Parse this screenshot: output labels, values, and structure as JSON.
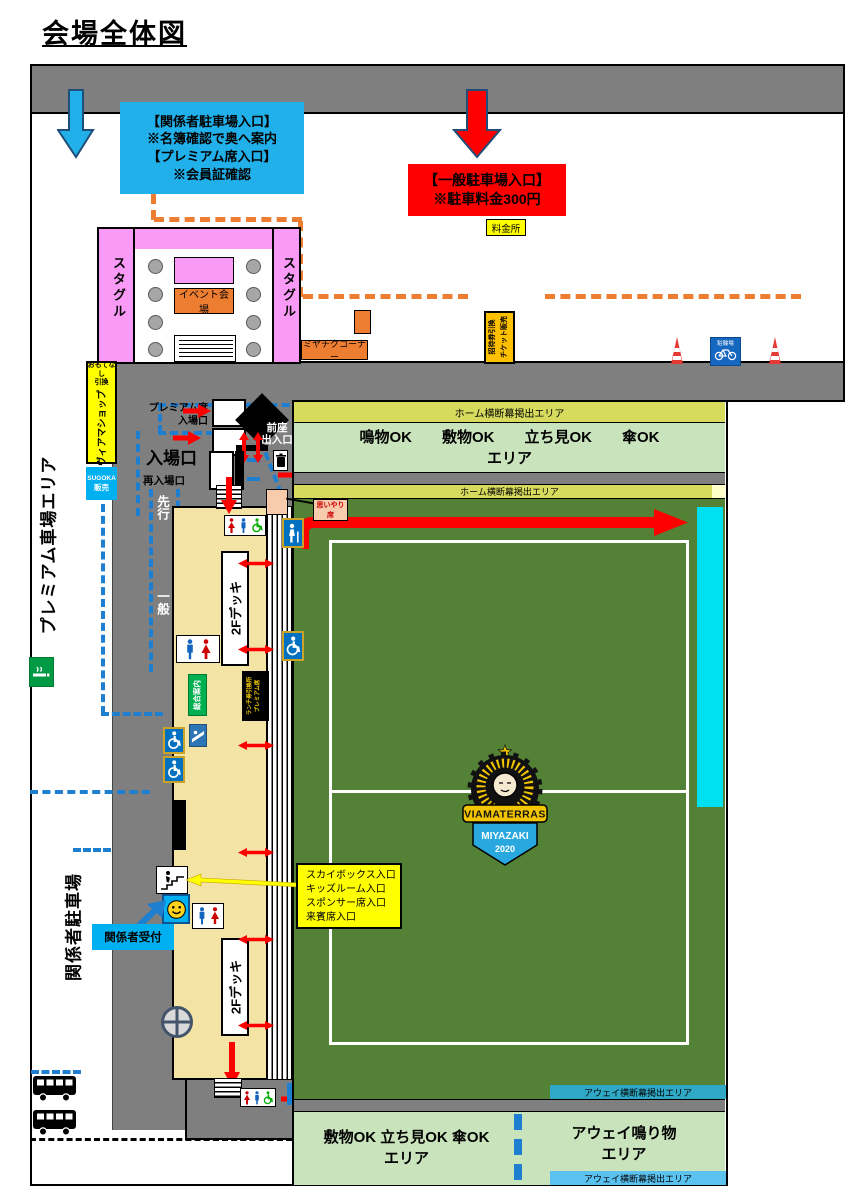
{
  "title": "会場全体図",
  "colors": {
    "accent_blue": "#22B0EA",
    "route_blue": "#1E7FD0",
    "arrow_red": "#FF0000",
    "orange": "#ED7D31",
    "banner_yellow": "#D6DB5E",
    "field_green": "#538135",
    "free_area_green": "#C9E3BC",
    "stand_tan": "#F3E3A5",
    "pink": "#F99BF6",
    "cyan_seats": "#00E0F0",
    "away_teal": "#2FA8C5",
    "away_lightblue": "#5BC2EF"
  },
  "notes": {
    "staff_parking_entrance": "【関係者駐車場入口】\n※名簿確認で奥へ案内\n【プレミアム席入口】\n※会員証確認",
    "general_parking_entrance": "【一般駐車場入口】\n※駐車料金300円",
    "toll_booth": "料金所",
    "skybox_entrances": "スカイボックス入口\nキッズルーム入口\nスポンサー席入口\n来賓席入口",
    "staff_reception": "関係者受付"
  },
  "areas": {
    "premium_parking": "プレミアム車場エリア",
    "staff_parking": "関係者駐車場",
    "stagle_left": "スタグル",
    "stagle_right": "スタグル",
    "event_hall": "イベント会場",
    "miyachiku": "ミヤチクコーナー",
    "home_banner_top": "ホーム横断幕掲出エリア",
    "home_banner_bottom": "ホーム横断幕掲出エリア",
    "home_free_area": "鳴物OK　　敷物OK　　立ち見OK　　傘OK\nエリア",
    "away_banner_top": "アウェイ横断幕掲出エリア",
    "away_banner_bottom": "アウェイ横断幕掲出エリア",
    "away_free_area": "敷物OK  立ち見OK  傘OK\nエリア",
    "away_noise_area": "アウェイ鳴り物\nエリア",
    "courtesy_seat": "思いやり席"
  },
  "facilities": {
    "hospitality_exchange": "おもてなし\n引換",
    "viama_shop": "ヴィアマショップ",
    "sugoka_line1": "SUGOKA",
    "sugoka_line2": "販売",
    "invitation_exchange": "招待券引換",
    "ticket_sales": "チケット販売",
    "bicycle_parking": "駐輪場",
    "info_center": "総合案内",
    "lunch_exchange": "ランチ券引換所",
    "premium_seat": "プレミアム席",
    "deck_2f": "2Fデッキ"
  },
  "gates": {
    "premium_gate": "プレミアム席\n入場口",
    "entrance": "入場口",
    "reentrance": "再入場口",
    "zenza_gate": "前座\n出入口",
    "lane_priority": "先行",
    "lane_general": "一般"
  },
  "logo": {
    "banner": "VIAMATERRAS",
    "city": "MIYAZAKI",
    "year": "2020"
  }
}
